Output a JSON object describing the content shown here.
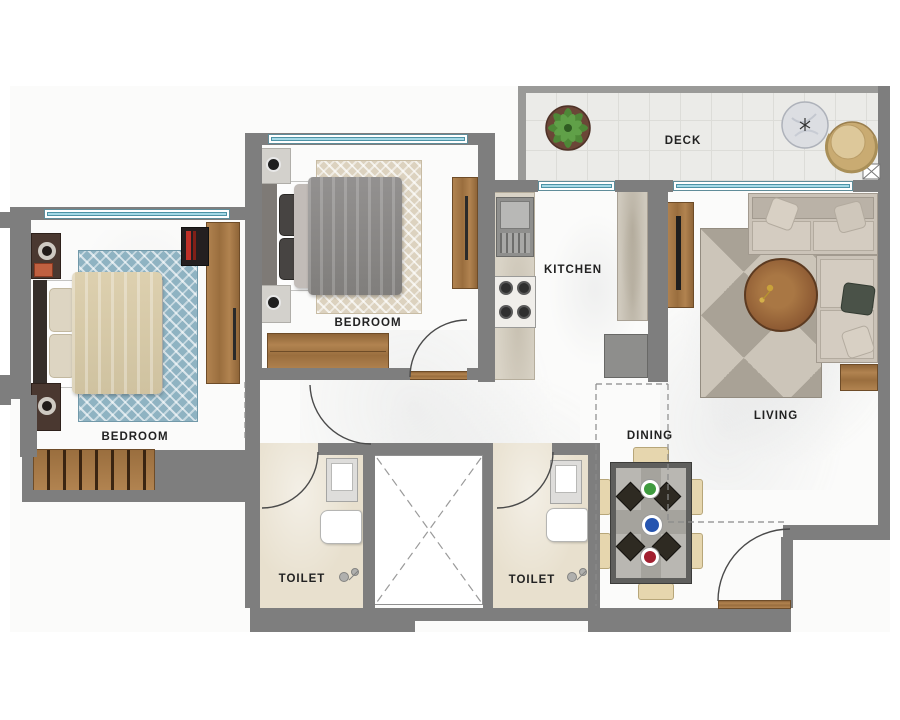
{
  "plan": {
    "type": "apartment-floor-plan",
    "description": "2BHK floor plan, top-down view"
  },
  "rooms": {
    "deck": {
      "label": "DECK"
    },
    "kitchen": {
      "label": "KITCHEN"
    },
    "living": {
      "label": "LIVING"
    },
    "dining": {
      "label": "DINING"
    },
    "bedroom_left": {
      "label": "BEDROOM"
    },
    "bedroom_middle": {
      "label": "BEDROOM"
    },
    "toilet_left": {
      "label": "TOILET"
    },
    "toilet_right": {
      "label": "TOILET"
    }
  },
  "palette": {
    "wall": "#7e7e7e",
    "marble_floor": "#fbfbfa",
    "deck_floor": "#ebebe8",
    "toilet_floor": "#e8e0ce",
    "window_glass": "#a5d9e6",
    "window_frame": "#5f8c99",
    "wood": "#a87c4c",
    "rug_blue": "#8fb3c2",
    "rug_beige": "#dcd2bf",
    "sofa": "#cbc3b8",
    "chair": "#e6d6ae",
    "plate_green": "#3f9b3f",
    "plate_blue": "#2554b0",
    "plate_red": "#a21f30",
    "plant_green": "#4d8c38",
    "door_arc": "#4a4a4a"
  },
  "icons": [
    "plant-icon",
    "deck-table-icon",
    "deck-chair-icon",
    "shaft-x-icon",
    "bed-icon",
    "rug",
    "nightstand-icon",
    "wardrobe-icon",
    "dresser-icon",
    "tv-unit-icon",
    "sofa-icon",
    "coffee-table-icon",
    "side-table-icon",
    "dining-table-icon",
    "dining-chair-icon",
    "kitchen-sink-icon",
    "stove-icon",
    "counter-icon",
    "fridge-icon",
    "wc-icon",
    "bathroom-sink-icon",
    "faucet-icon",
    "door-arc",
    "window",
    "vent-strip"
  ]
}
